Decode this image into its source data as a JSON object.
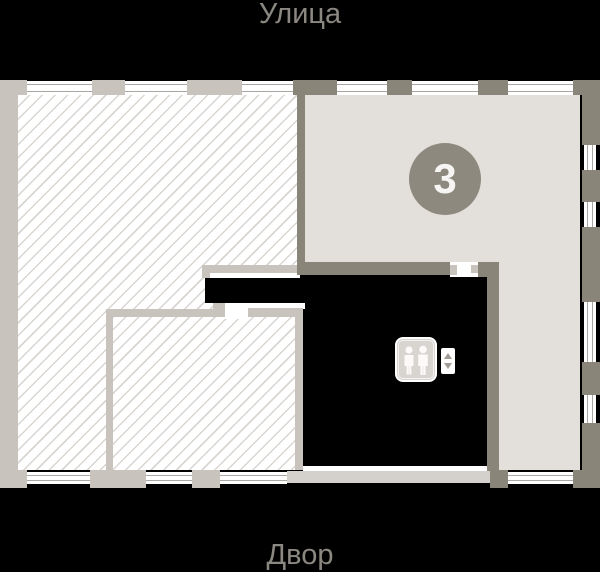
{
  "canvas": {
    "background": "#000000",
    "width": 600,
    "height": 572
  },
  "labels": {
    "street": "Улица",
    "courtyard": "Двор",
    "text_color": "#8b8781"
  },
  "floor_plan": {
    "apartment_badge": {
      "number": "3",
      "bg_color": "#8d897e",
      "text_color": "#f6f5f3"
    },
    "areas": {
      "hatched_apartment": {
        "fill": "#ffffff",
        "hatch_line_color": "#d9d6d2"
      },
      "common_area": {
        "fill": "#e3e0db"
      },
      "core_area": {
        "fill": "#000000"
      }
    },
    "walls": {
      "dark_color": "#8a8579",
      "light_color": "#c8c4bd",
      "light_bar_color": "#d4d1cd",
      "window_line_color": "#aaa7a2"
    },
    "elevator": {
      "icon": "elevator-people-icon",
      "cabin_fill": "#d8d5d1",
      "controls": [
        "arrow-up-icon",
        "arrow-down-icon"
      ]
    }
  }
}
